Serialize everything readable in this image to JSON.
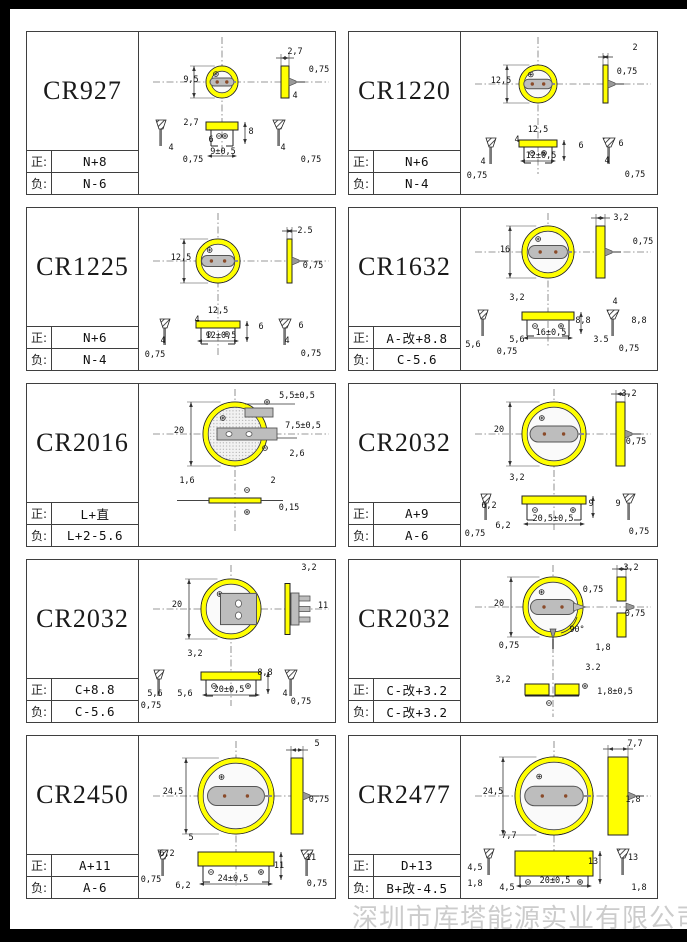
{
  "page": {
    "company_watermark": "深圳市库塔能源实业有限公司",
    "pos_label": "正:",
    "neg_label": "负:",
    "colors": {
      "battery_yellow": "#ffff00",
      "tab_gray": "#bdbdbd",
      "line_dark": "#2a2a2a",
      "watermark_gray": "#cccccc"
    }
  },
  "cells": [
    {
      "model": "CR927",
      "pos": "N+8",
      "neg": "N-6",
      "variant": "std",
      "geom": {
        "cx": 83,
        "cy": 50,
        "r": 16,
        "sx": 142,
        "sw": 8,
        "by": 90,
        "bh": 8,
        "lpx": 22,
        "rpx": 140,
        "bdy": 124
      },
      "dims": [
        {
          "t": "2,7",
          "x": 156,
          "y": 22
        },
        {
          "t": "0,75",
          "x": 180,
          "y": 40
        },
        {
          "t": "9,5",
          "x": 52,
          "y": 50
        },
        {
          "t": "4",
          "x": 156,
          "y": 66
        },
        {
          "t": "2,7",
          "x": 52,
          "y": 93
        },
        {
          "t": "6",
          "x": 72,
          "y": 110
        },
        {
          "t": "9±0,5",
          "x": 84,
          "y": 122
        },
        {
          "t": "8",
          "x": 112,
          "y": 102
        },
        {
          "t": "0,75",
          "x": 54,
          "y": 130
        },
        {
          "t": "4",
          "x": 32,
          "y": 118
        },
        {
          "t": "4",
          "x": 144,
          "y": 118
        },
        {
          "t": "0,75",
          "x": 172,
          "y": 130
        }
      ]
    },
    {
      "model": "CR1220",
      "pos": "N+6",
      "neg": "N-4",
      "variant": "std",
      "geom": {
        "cx": 77,
        "cy": 52,
        "r": 19,
        "sx": 142,
        "sw": 5,
        "by": 108,
        "bh": 7,
        "lpx": 30,
        "rpx": 148,
        "bdy": 129
      },
      "dims": [
        {
          "t": "2",
          "x": 174,
          "y": 18
        },
        {
          "t": "0,75",
          "x": 166,
          "y": 42
        },
        {
          "t": "12,5",
          "x": 40,
          "y": 51
        },
        {
          "t": "12,5",
          "x": 77,
          "y": 100
        },
        {
          "t": "4",
          "x": 56,
          "y": 110
        },
        {
          "t": "12±0,5",
          "x": 80,
          "y": 126
        },
        {
          "t": "6",
          "x": 120,
          "y": 116
        },
        {
          "t": "4",
          "x": 22,
          "y": 132
        },
        {
          "t": "0,75",
          "x": 16,
          "y": 146
        },
        {
          "t": "6",
          "x": 160,
          "y": 114
        },
        {
          "t": "4",
          "x": 146,
          "y": 131
        },
        {
          "t": "0,75",
          "x": 174,
          "y": 145
        }
      ]
    },
    {
      "model": "CR1225",
      "pos": "N+6",
      "neg": "N-4",
      "variant": "std",
      "geom": {
        "cx": 79,
        "cy": 53,
        "r": 22,
        "sx": 148,
        "sw": 5,
        "by": 113,
        "bh": 7,
        "lpx": 26,
        "rpx": 146,
        "bdy": 133
      },
      "dims": [
        {
          "t": "2.5",
          "x": 166,
          "y": 25
        },
        {
          "t": "0,75",
          "x": 174,
          "y": 60
        },
        {
          "t": "12,5",
          "x": 42,
          "y": 52
        },
        {
          "t": "12,5",
          "x": 79,
          "y": 105
        },
        {
          "t": "4",
          "x": 58,
          "y": 114
        },
        {
          "t": "12±0,5",
          "x": 82,
          "y": 130
        },
        {
          "t": "6",
          "x": 122,
          "y": 121
        },
        {
          "t": "4",
          "x": 24,
          "y": 135
        },
        {
          "t": "0,75",
          "x": 16,
          "y": 149
        },
        {
          "t": "6",
          "x": 162,
          "y": 120
        },
        {
          "t": "4",
          "x": 148,
          "y": 135
        },
        {
          "t": "0,75",
          "x": 172,
          "y": 148
        }
      ]
    },
    {
      "model": "CR1632",
      "pos": "A-改+8.8",
      "neg": "C-5.6",
      "variant": "std",
      "geom": {
        "cx": 87,
        "cy": 44,
        "r": 26,
        "sx": 135,
        "sw": 9,
        "by": 104,
        "bh": 8,
        "lpx": 22,
        "rpx": 152,
        "bdy": 130
      },
      "dims": [
        {
          "t": "3,2",
          "x": 160,
          "y": 12
        },
        {
          "t": "0,75",
          "x": 182,
          "y": 36
        },
        {
          "t": "16",
          "x": 44,
          "y": 44
        },
        {
          "t": "3,2",
          "x": 56,
          "y": 92
        },
        {
          "t": "5,6",
          "x": 12,
          "y": 139
        },
        {
          "t": "0,75",
          "x": 46,
          "y": 146
        },
        {
          "t": "5,6",
          "x": 56,
          "y": 134
        },
        {
          "t": "16±0,5",
          "x": 90,
          "y": 127
        },
        {
          "t": "8,8",
          "x": 122,
          "y": 115
        },
        {
          "t": "4",
          "x": 154,
          "y": 96
        },
        {
          "t": "8,8",
          "x": 178,
          "y": 115
        },
        {
          "t": "3.5",
          "x": 140,
          "y": 134
        },
        {
          "t": "0,75",
          "x": 168,
          "y": 143
        }
      ]
    },
    {
      "model": "CR2016",
      "pos": "L+直",
      "neg": "L+2-5.6",
      "variant": "flat",
      "geom": {
        "cx": 96,
        "cy": 50,
        "r": 32,
        "sx": 0,
        "sw": 0,
        "by": 114,
        "bh": 5,
        "lpx": 0,
        "rpx": 0,
        "bdy": 0
      },
      "dims": [
        {
          "t": "20",
          "x": 40,
          "y": 49
        },
        {
          "t": "5,5±0,5",
          "x": 158,
          "y": 14
        },
        {
          "t": "7,5±0,5",
          "x": 164,
          "y": 44
        },
        {
          "t": "2,6",
          "x": 158,
          "y": 72
        },
        {
          "t": "1,6",
          "x": 48,
          "y": 99
        },
        {
          "t": "2",
          "x": 134,
          "y": 99
        },
        {
          "t": "0,15",
          "x": 150,
          "y": 126
        }
      ]
    },
    {
      "model": "CR2032",
      "pos": "A+9",
      "neg": "A-6",
      "variant": "std",
      "geom": {
        "cx": 93,
        "cy": 50,
        "r": 32,
        "sx": 155,
        "sw": 9,
        "by": 112,
        "bh": 8,
        "lpx": 25,
        "rpx": 168,
        "bdy": 140
      },
      "dims": [
        {
          "t": "3,2",
          "x": 168,
          "y": 12
        },
        {
          "t": "0,75",
          "x": 175,
          "y": 60
        },
        {
          "t": "20",
          "x": 38,
          "y": 48
        },
        {
          "t": "3,2",
          "x": 56,
          "y": 96
        },
        {
          "t": "6,2",
          "x": 28,
          "y": 124
        },
        {
          "t": "6,2",
          "x": 42,
          "y": 144
        },
        {
          "t": "20,5±0,5",
          "x": 92,
          "y": 137
        },
        {
          "t": "9",
          "x": 130,
          "y": 122
        },
        {
          "t": "9",
          "x": 157,
          "y": 122
        },
        {
          "t": "0,75",
          "x": 14,
          "y": 152
        },
        {
          "t": "0,75",
          "x": 178,
          "y": 150
        }
      ]
    },
    {
      "model": "CR2032",
      "pos": "C+8.8",
      "neg": "C-5.6",
      "variant": "clip",
      "geom": {
        "cx": 92,
        "cy": 49,
        "r": 30,
        "sx": 150,
        "sw": 5,
        "by": 112,
        "bh": 8,
        "lpx": 20,
        "rpx": 152,
        "bdy": 135
      },
      "dims": [
        {
          "t": "3,2",
          "x": 170,
          "y": 10
        },
        {
          "t": "11",
          "x": 184,
          "y": 48
        },
        {
          "t": "20",
          "x": 38,
          "y": 47
        },
        {
          "t": "3,2",
          "x": 56,
          "y": 96
        },
        {
          "t": "5,6",
          "x": 16,
          "y": 136
        },
        {
          "t": "5,6",
          "x": 46,
          "y": 136
        },
        {
          "t": "20±0,5",
          "x": 90,
          "y": 132
        },
        {
          "t": "8,8",
          "x": 126,
          "y": 115
        },
        {
          "t": "4",
          "x": 146,
          "y": 136
        },
        {
          "t": "0,75",
          "x": 12,
          "y": 148
        },
        {
          "t": "0,75",
          "x": 162,
          "y": 144
        }
      ]
    },
    {
      "model": "CR2032",
      "pos": "C-改+3.2",
      "neg": "C-改+3.2",
      "variant": "bend",
      "geom": {
        "cx": 92,
        "cy": 47,
        "r": 30,
        "sx": 156,
        "sw": 9,
        "by": 124,
        "bh": 11,
        "lpx": 0,
        "rpx": 0,
        "bdy": 0
      },
      "dims": [
        {
          "t": "3,2",
          "x": 170,
          "y": 10
        },
        {
          "t": "20",
          "x": 38,
          "y": 46
        },
        {
          "t": "0,75",
          "x": 132,
          "y": 32
        },
        {
          "t": "0,75",
          "x": 174,
          "y": 56
        },
        {
          "t": "90°",
          "x": 116,
          "y": 72
        },
        {
          "t": "0,75",
          "x": 48,
          "y": 88
        },
        {
          "t": "1,8",
          "x": 142,
          "y": 90
        },
        {
          "t": "3,2",
          "x": 42,
          "y": 122
        },
        {
          "t": "3.2",
          "x": 132,
          "y": 110
        },
        {
          "t": "1,8±0,5",
          "x": 154,
          "y": 134
        }
      ]
    },
    {
      "model": "CR2450",
      "pos": "A+11",
      "neg": "A-6",
      "variant": "std",
      "geom": {
        "cx": 97,
        "cy": 60,
        "r": 38,
        "sx": 152,
        "sw": 12,
        "by": 116,
        "bh": 14,
        "lpx": 24,
        "rpx": 168,
        "bdy": 148
      },
      "dims": [
        {
          "t": "5",
          "x": 178,
          "y": 10
        },
        {
          "t": "24,5",
          "x": 34,
          "y": 58
        },
        {
          "t": "0,75",
          "x": 180,
          "y": 66
        },
        {
          "t": "5",
          "x": 52,
          "y": 104
        },
        {
          "t": "6,2",
          "x": 28,
          "y": 120
        },
        {
          "t": "0,75",
          "x": 12,
          "y": 146
        },
        {
          "t": "6,2",
          "x": 44,
          "y": 152
        },
        {
          "t": "24±0,5",
          "x": 94,
          "y": 145
        },
        {
          "t": "11",
          "x": 140,
          "y": 132
        },
        {
          "t": "11",
          "x": 172,
          "y": 124
        },
        {
          "t": "0,75",
          "x": 178,
          "y": 150
        }
      ]
    },
    {
      "model": "CR2477",
      "pos": "D+13",
      "neg": "B+改-4.5",
      "variant": "std",
      "geom": {
        "cx": 93,
        "cy": 60,
        "r": 39,
        "sx": 147,
        "sw": 20,
        "by": 115,
        "bh": 25,
        "lpx": 28,
        "rpx": 162,
        "bdy": 150
      },
      "dims": [
        {
          "t": "7,7",
          "x": 174,
          "y": 10
        },
        {
          "t": "24,5",
          "x": 32,
          "y": 58
        },
        {
          "t": "1,8",
          "x": 172,
          "y": 66
        },
        {
          "t": "7,7",
          "x": 48,
          "y": 102
        },
        {
          "t": "4,5",
          "x": 14,
          "y": 134
        },
        {
          "t": "1,8",
          "x": 14,
          "y": 150
        },
        {
          "t": "4,5",
          "x": 46,
          "y": 154
        },
        {
          "t": "20±0,5",
          "x": 94,
          "y": 147
        },
        {
          "t": "13",
          "x": 132,
          "y": 128
        },
        {
          "t": "13",
          "x": 172,
          "y": 124
        },
        {
          "t": "1,8",
          "x": 178,
          "y": 154
        }
      ]
    }
  ]
}
